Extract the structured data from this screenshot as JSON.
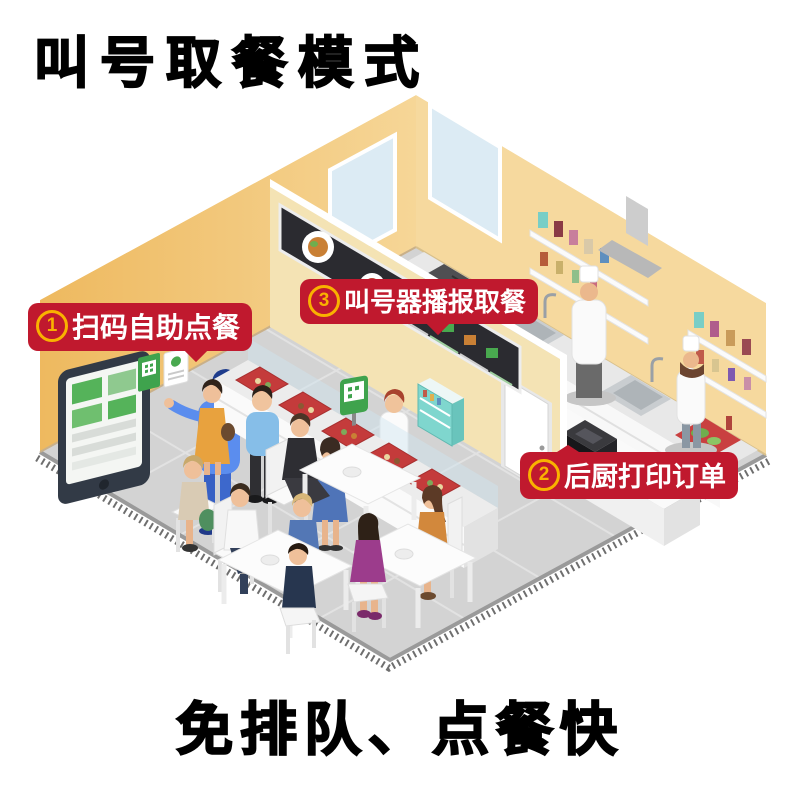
{
  "title": "叫号取餐模式",
  "slogan": "免排队、点餐快",
  "steps": [
    {
      "number": "1",
      "label": "扫码自助点餐"
    },
    {
      "number": "2",
      "label": "后厨打印订单"
    },
    {
      "number": "3",
      "label": "叫号器播报取餐"
    }
  ],
  "colors": {
    "badge_bg": "#C0192E",
    "badge_text": "#FFFFFF",
    "badge_number_ring": "#F9B200",
    "title_text": "#000000",
    "wall_left": "#EFBD66",
    "wall_back": "#F6D99E",
    "divider_wall": "#F4E3B4",
    "floor": "#D3D3D3",
    "tray_red": "#C43B3B",
    "fridge_teal": "#7FD6CE",
    "menu_board": "#2B2B30",
    "menu_green": "#49A94F"
  }
}
